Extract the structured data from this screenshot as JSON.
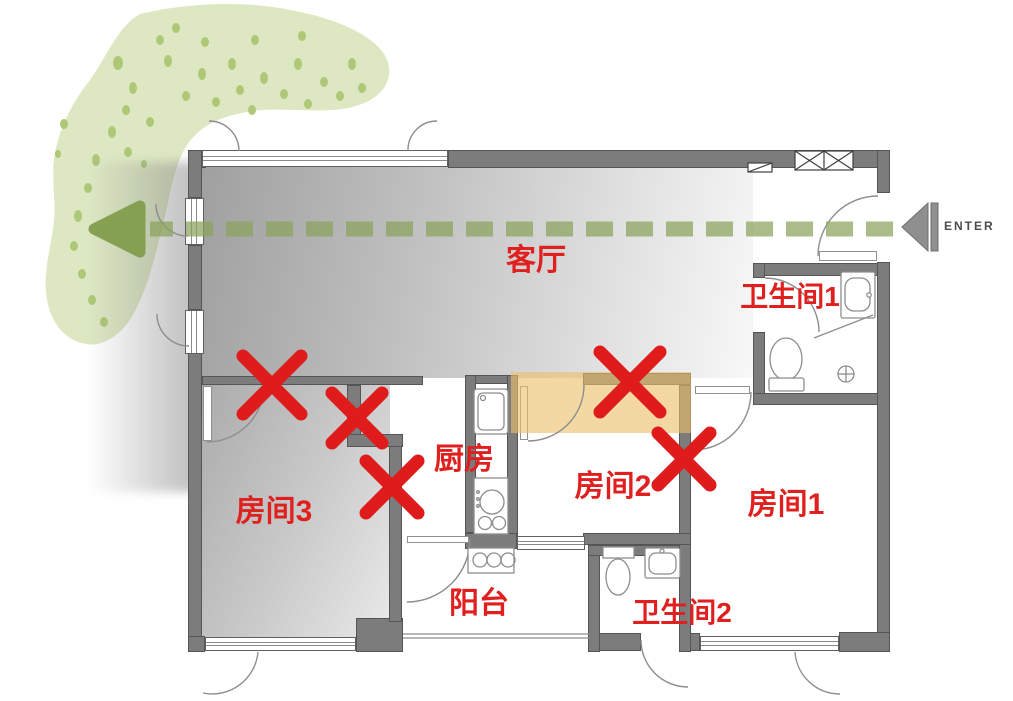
{
  "diagram": {
    "title": "apartment floor plan with demolition marks",
    "rooms": {
      "living_room": "客厅",
      "bathroom1": "卫生间1",
      "kitchen": "厨房",
      "room2": "房间2",
      "room1": "房间1",
      "room3": "房间3",
      "balcony": "阳台",
      "bathroom2": "卫生间2"
    },
    "entrance_label": "ENTER",
    "demolition_marks": [
      {
        "x": 272,
        "y": 385,
        "size": 58
      },
      {
        "x": 357,
        "y": 418,
        "size": 50
      },
      {
        "x": 392,
        "y": 487,
        "size": 52
      },
      {
        "x": 630,
        "y": 382,
        "size": 60
      },
      {
        "x": 684,
        "y": 459,
        "size": 52
      }
    ],
    "colors": {
      "label": "#e01f1f",
      "mark": "#df1b1b",
      "highlight": "#eec06a",
      "path_green": "#8ba35b",
      "arrowhead_green": "#84a050",
      "vegetation": "#dde8c3",
      "vegetation_dot": "#aec878",
      "wall": "#7c7c7c"
    }
  }
}
